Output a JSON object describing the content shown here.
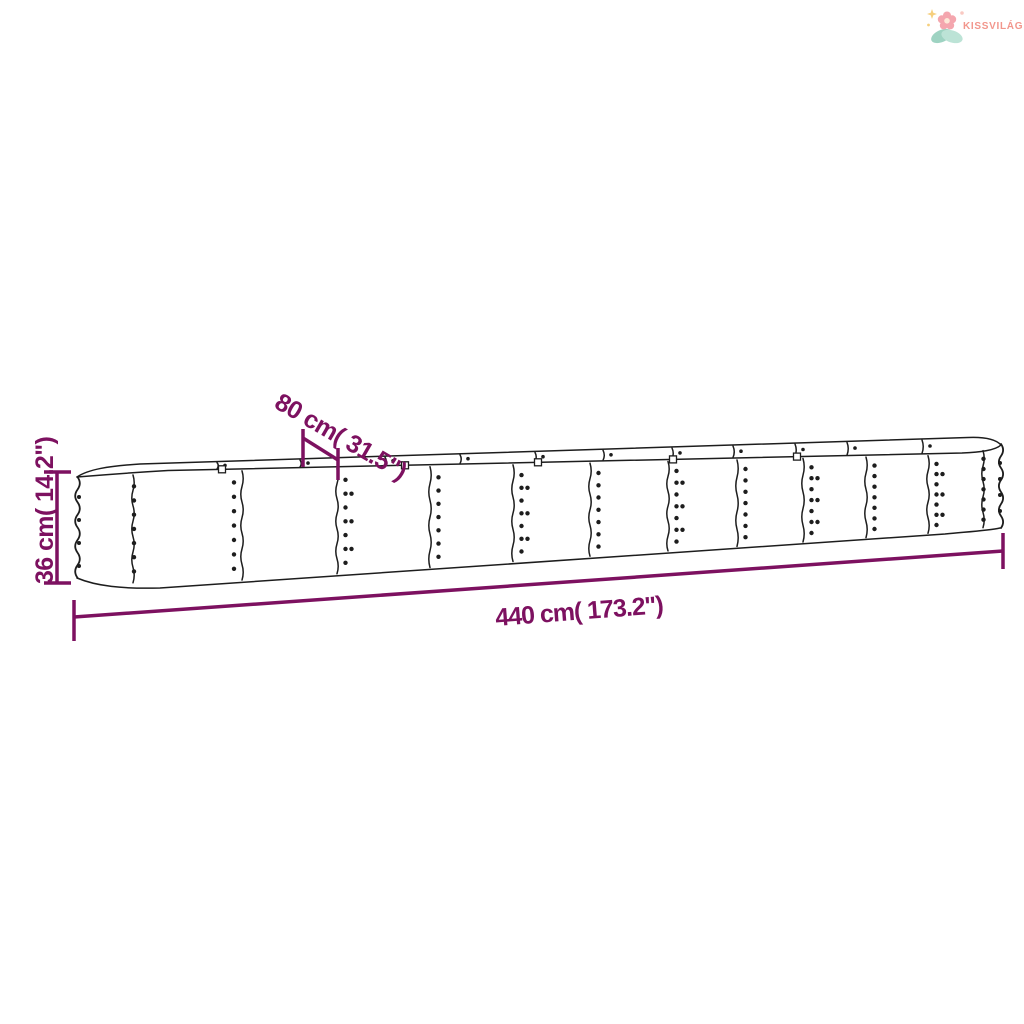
{
  "brand": {
    "name": "KISSVILÁG",
    "color": "#f2968c",
    "icon": "flower-with-leaves-and-sparkle"
  },
  "diagram": {
    "annotation_color": "#7d1160",
    "line_color": "#1d1d1d",
    "dimensions": {
      "width": {
        "label": "80 cm( 31.5\")"
      },
      "height": {
        "label": "36 cm( 14.2\")"
      },
      "length": {
        "label": "440 cm( 173.2\")"
      }
    }
  }
}
